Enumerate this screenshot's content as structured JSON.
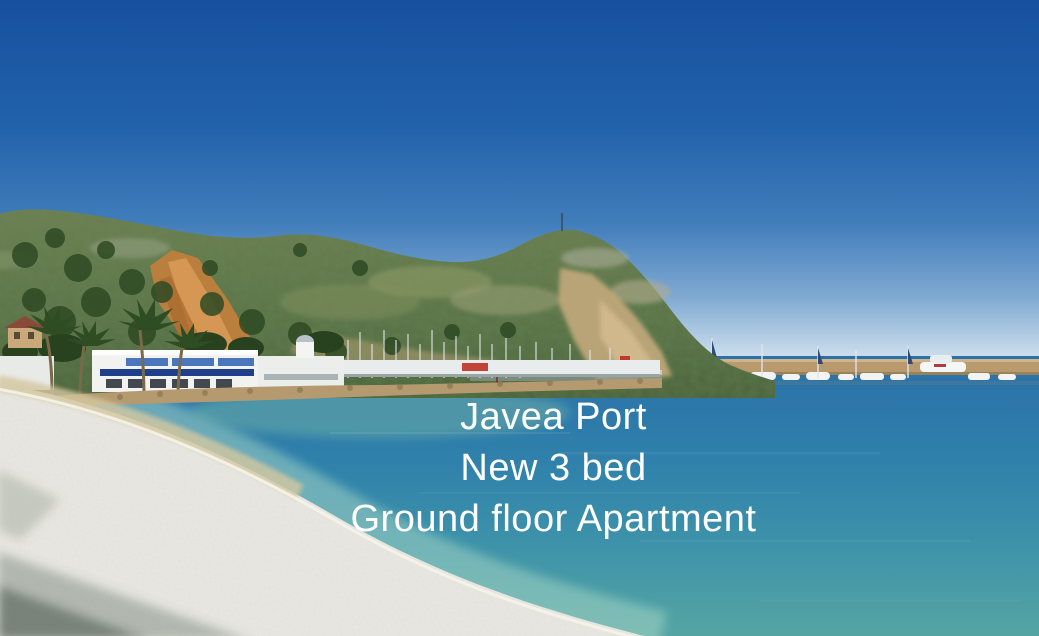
{
  "overlay": {
    "line1": "Javea Port",
    "line2": "New 3 bed",
    "line3": "Ground floor Apartment",
    "text_color": "#ffffff"
  },
  "scene": {
    "kind": "photograph",
    "subject": "javea-port-beach-and-harbour",
    "elements": [
      "sky",
      "headland-hill",
      "orange-cliff",
      "tan-cliff",
      "summit-antenna",
      "harbour-buildings",
      "blue-awnings",
      "palm-trees",
      "sailboat-masts",
      "breakwater-wall",
      "moored-boats",
      "red-beacon",
      "red-flag-marker",
      "rock-riprap",
      "sea",
      "shoreline-foam",
      "pebble-beach",
      "beach-shadow"
    ],
    "colors": {
      "sky_top": "#17509f",
      "sky_mid": "#3f7cba",
      "sky_horizon": "#e2ecf3",
      "sea_deep": "#2b70a8",
      "sea_teal": "#3e93a9",
      "sea_shallow": "#9ccbbc",
      "hill_green": "#5a7347",
      "tree_green": "#2e4a24",
      "cliff_orange": "#c07f3c",
      "rock_tan": "#c2a87c",
      "breakwater": "#b89a6e",
      "beach_white": "#e9e8e2",
      "sand_tan": "#d4c7a0",
      "shadow_olive": "#4f6052",
      "awning_blue": "#3a66b0",
      "beacon_red": "#c0392b"
    }
  }
}
